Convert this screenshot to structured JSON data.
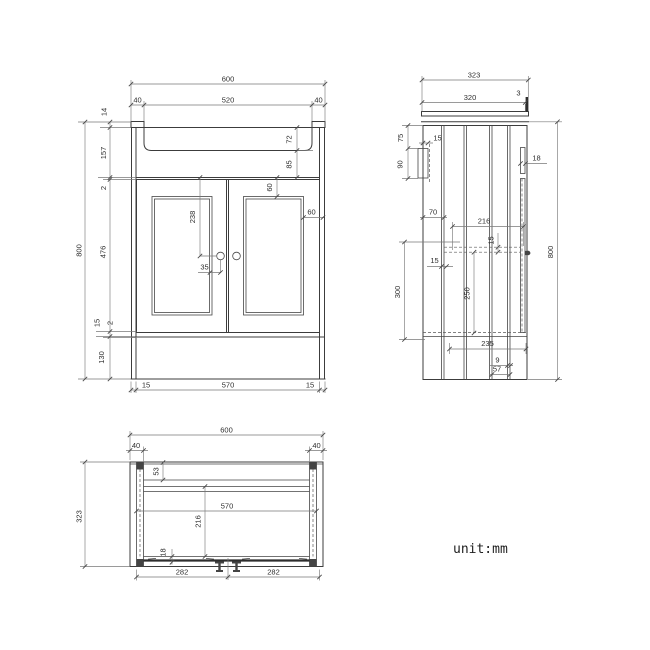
{
  "unit_label": "unit:mm",
  "front": {
    "total_width": "600",
    "basin_offset_left": "40",
    "basin_width": "520",
    "basin_offset_right": "40",
    "counter_thickness": "14",
    "apron_height": "157",
    "top_gap": "2",
    "door_height": "476",
    "bottom_gap": "15",
    "bottom_gap2": "2",
    "plinth_height": "130",
    "total_height": "800",
    "basin_depth": "72",
    "basin_to_doors": "85",
    "panel_top_inset": "60",
    "panel_side_inset": "60",
    "handle_drop": "238",
    "handle_offset": "35",
    "side_panel_left": "15",
    "inner_width": "570",
    "side_panel_right": "15"
  },
  "side": {
    "total_depth": "323",
    "counter_depth": "320",
    "back_overhang": "3",
    "bracket_top_offset": "75",
    "bracket_width": "15",
    "bracket_height": "90",
    "front_offset": "70",
    "shelf_depth": "216",
    "shelf_thickness": "15",
    "rail_width": "15",
    "shelf_span": "300",
    "shelf_to_base": "250",
    "base_depth": "235",
    "groove_width": "9",
    "back_inset": "57",
    "door_thickness": "18",
    "total_height": "800"
  },
  "plan": {
    "total_width": "600",
    "leg_left": "40",
    "leg_right": "40",
    "back_rail_depth": "53",
    "inner_width": "570",
    "inner_depth": "216",
    "door_thickness": "18",
    "hinge_span_left": "282",
    "hinge_span_right": "282",
    "total_depth": "323"
  }
}
